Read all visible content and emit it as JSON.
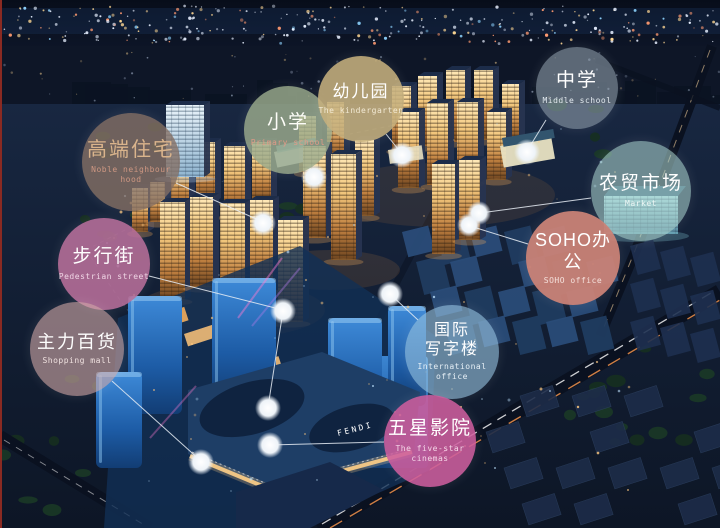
{
  "labels": {
    "noble": {
      "zh": "高端住宅",
      "en": "Noble neighbour hood",
      "bg": "rgba(134,113,101,0.80)",
      "zh_color": "#dab48c",
      "en_color": "#d39a84"
    },
    "primary": {
      "zh": "小学",
      "en": "Primary school",
      "bg": "rgba(156,172,141,0.82)",
      "zh_color": "#fdfdf8",
      "en_color": "#e59a88"
    },
    "kindergarten": {
      "zh": "幼儿园",
      "en": "The kindergarten",
      "bg": "rgba(198,176,126,0.88)",
      "zh_color": "#ffffff",
      "en_color": "#f6eed9"
    },
    "middle": {
      "zh": "中学",
      "en": "Middle school",
      "bg": "rgba(141,155,168,0.62)",
      "zh_color": "#ffffff",
      "en_color": "#e9f0f5"
    },
    "market": {
      "zh": "农贸市场",
      "en": "Market",
      "bg": "rgba(172,212,206,0.58)",
      "zh_color": "#ffffff",
      "en_color": "#f2faf8"
    },
    "pedestrian": {
      "zh": "步行街",
      "en": "Pedestrian street",
      "bg": "rgba(184,111,155,0.88)",
      "zh_color": "#ffffff",
      "en_color": "#f4dcea"
    },
    "soho": {
      "zh": "SOHO办公",
      "en": "SOHO office",
      "bg": "rgba(203,131,119,0.94)",
      "zh_color": "#ffffff",
      "en_color": "#f8e6e1"
    },
    "shopping": {
      "zh": "主力百货",
      "en": "Shopping mall",
      "bg": "rgba(214,172,170,0.60)",
      "zh_color": "#fefefe",
      "en_color": "#f6e8e6"
    },
    "intl_office": {
      "zh": "国际\n写字楼",
      "en": "International\noffice",
      "bg": "rgba(152,196,224,0.62)",
      "zh_color": "#ffffff",
      "en_color": "#edf5fb"
    },
    "cinema": {
      "zh": "五星影院",
      "en": "The five-star cinemas",
      "bg": "rgba(206,94,158,0.88)",
      "zh_color": "#ffffff",
      "en_color": "#f8dcec"
    }
  },
  "scene": {
    "mall_sign": "FENDI"
  }
}
